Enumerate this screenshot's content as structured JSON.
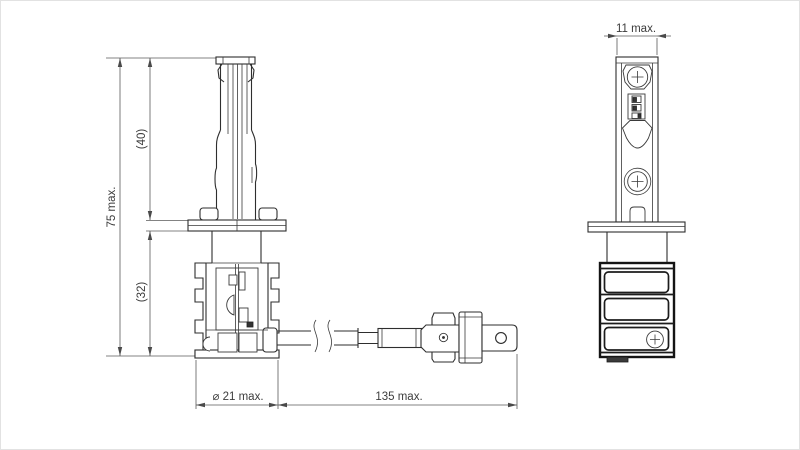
{
  "drawing_type": "technical-dimension-drawing",
  "front_view": {
    "dims": {
      "height_total": "75 max.",
      "tip_to_flange": "(40)",
      "flange_to_base": "(32)",
      "diameter": "⌀ 21 max.",
      "overall_length": "135 max."
    }
  },
  "side_view": {
    "dims": {
      "width": "11 max."
    }
  },
  "colors": {
    "background": "#ffffff",
    "line": "#2e2e2e",
    "dimension": "#4a4a4a"
  }
}
